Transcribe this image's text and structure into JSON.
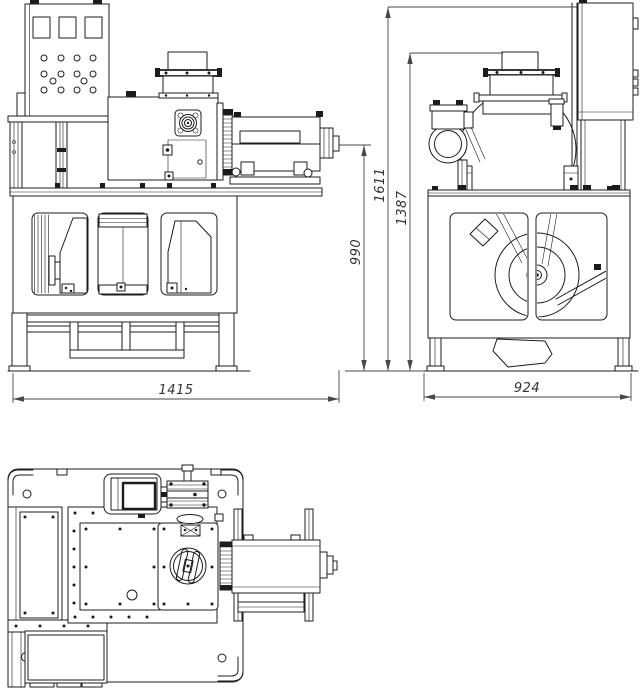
{
  "drawing": {
    "background_color": "#ffffff",
    "line_color": "#1c1c1c",
    "dimension_color": "#474747",
    "dimensions": {
      "front_width": "1415",
      "shaft_height": "990",
      "total_height": "1611",
      "hopper_height": "1387",
      "side_width": "924"
    }
  }
}
